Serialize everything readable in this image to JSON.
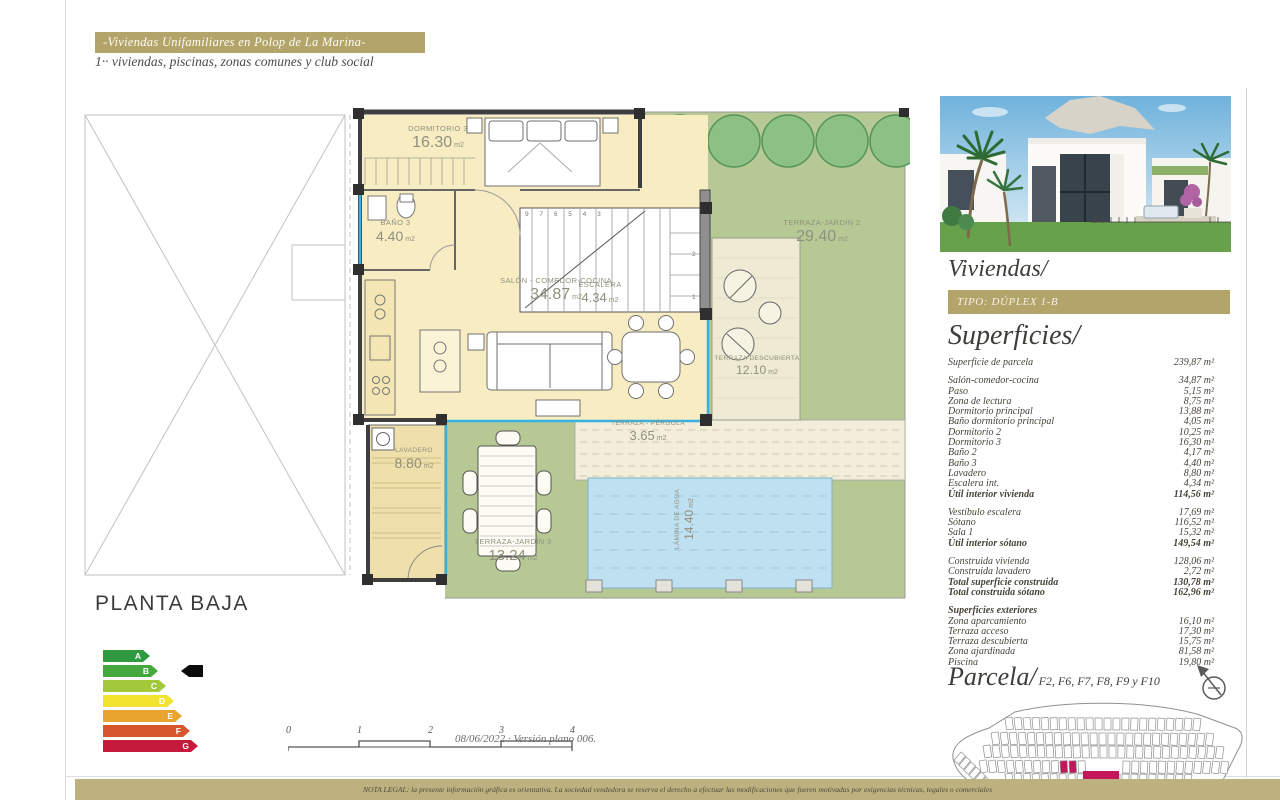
{
  "header": {
    "banner": "-Viviendas Unifamiliares en Polop de La Marina-",
    "subtitle": "1·· viviendas, piscinas, zonas comunes y club social"
  },
  "plan": {
    "title": "PLANTA BAJA",
    "unit": "m2",
    "rooms": [
      {
        "name": "DORMITORIO 3",
        "area": "16.30"
      },
      {
        "name": "BAÑO 3",
        "area": "4.40"
      },
      {
        "name": "SALÓN - COMEDOR-COCINA",
        "area": "34.87"
      },
      {
        "name": "ESCALERA",
        "area": "4.34"
      },
      {
        "name": "TERRAZA-JARDÍN 2",
        "area": "29.40"
      },
      {
        "name": "TERRAZA DESCUBIERTA",
        "area": "12.10"
      },
      {
        "name": "TERRAZA - PÉRGOLA",
        "area": "3.65"
      },
      {
        "name": "LAVADERO",
        "area": "8.80"
      },
      {
        "name": "TERRAZA-JARDÍN 3",
        "area": "13.24"
      },
      {
        "name": "LÁMINA DE AGUA",
        "area": "14.40"
      }
    ],
    "stairs": {
      "top": "9 7 6 5 4 3",
      "n2": "2",
      "n1": "1"
    }
  },
  "energy": {
    "active": "B",
    "grades": [
      {
        "letter": "A",
        "color": "#2e9b41"
      },
      {
        "letter": "B",
        "color": "#43a83e"
      },
      {
        "letter": "C",
        "color": "#a3c83a"
      },
      {
        "letter": "D",
        "color": "#f2e32f"
      },
      {
        "letter": "E",
        "color": "#e9a42f"
      },
      {
        "letter": "F",
        "color": "#d6562e"
      },
      {
        "letter": "G",
        "color": "#c51a3b"
      }
    ]
  },
  "scalebar": {
    "ticks": [
      "0",
      "1",
      "2",
      "3",
      "4"
    ],
    "caption": "08/06/2022 · Versión plano 006."
  },
  "sidebar": {
    "viviendas_title": "Viviendas/",
    "tipo_banner": "TIPO: DÚPLEX 1-B",
    "superficies_title": "Superficies/",
    "parcela_title": "Parcela/",
    "parcela_codes": "F2, F6, F7, F8, F9 y F10",
    "sections": [
      {
        "rows": [
          {
            "label": "Superficie de parcela",
            "value": "239,87 m²",
            "bold": false
          }
        ]
      },
      {
        "rows": [
          {
            "label": "Salón-comedor-cocina",
            "value": "34,87 m²"
          },
          {
            "label": "Paso",
            "value": "5,15 m²"
          },
          {
            "label": "Zona de lectura",
            "value": "8,75 m²"
          },
          {
            "label": "Dormitorio principal",
            "value": "13,88 m²"
          },
          {
            "label": "Baño dormitorio principal",
            "value": "4,05 m²"
          },
          {
            "label": "Dormitorio 2",
            "value": "10,25 m²"
          },
          {
            "label": "Dormitorio 3",
            "value": "16,30 m²"
          },
          {
            "label": "Baño 2",
            "value": "4,17 m²"
          },
          {
            "label": "Baño 3",
            "value": "4,40 m²"
          },
          {
            "label": "Lavadero",
            "value": "8,80 m²"
          },
          {
            "label": "Escalera int.",
            "value": "4,34 m²"
          },
          {
            "label": "Útil interior vivienda",
            "value": "114,56 m²",
            "bold": true
          }
        ]
      },
      {
        "rows": [
          {
            "label": "Vestíbulo escalera",
            "value": "17,69 m²"
          },
          {
            "label": "Sótano",
            "value": "116,52 m²"
          },
          {
            "label": "Sala 1",
            "value": "15,32 m²"
          },
          {
            "label": "Útil interior sótano",
            "value": "149,54 m²",
            "bold": true
          }
        ]
      },
      {
        "rows": [
          {
            "label": "Construida vivienda",
            "value": "128,06 m²"
          },
          {
            "label": "Construida lavadero",
            "value": "2,72 m²"
          },
          {
            "label": "Total superficie construida",
            "value": "130,78 m²",
            "bold": true
          },
          {
            "label": "Total construida sótano",
            "value": "162,96 m²",
            "bold": true
          }
        ]
      },
      {
        "rows": [
          {
            "label": "Superficies exteriores",
            "value": "",
            "bold": true
          },
          {
            "label": "Zona aparcamiento",
            "value": "16,10 m²"
          },
          {
            "label": "Terraza acceso",
            "value": "17,30 m²"
          },
          {
            "label": "Terraza descubierta",
            "value": "15,75 m²"
          },
          {
            "label": "Zona ajardinada",
            "value": "81,58 m²"
          },
          {
            "label": "Piscina",
            "value": "19,80 m²"
          }
        ]
      }
    ]
  },
  "footer": {
    "legal": "NOTA LEGAL: la presente información gráfica es orientativa. La sociedad vendedora se reserva el derecho a efectuar las modificaciones que fueren motivadas por exigencias técnicas, legales o comerciales"
  },
  "colors": {
    "accent_gold": "#b3a469",
    "plan_cream": "#f8ecc3",
    "plan_green": "#b6c994",
    "pool_blue": "#bfe0f0",
    "parcel_pink": "#c4175b"
  }
}
